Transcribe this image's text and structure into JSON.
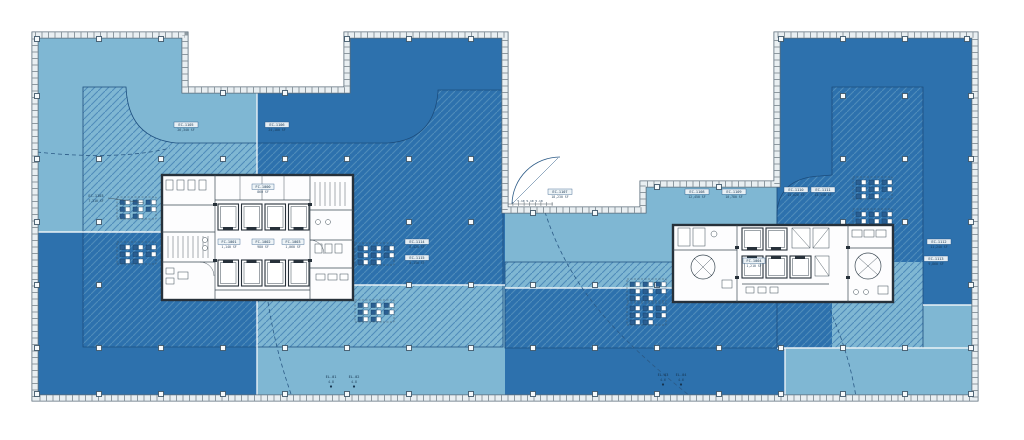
{
  "plan": {
    "colors": {
      "zone_light": "#7fb7d3",
      "zone_dark": "#2d71ad",
      "hatch_line": "#4f8cba",
      "boundary": "#1c4d7d",
      "wall": "#27313a",
      "core_fill": "#fdfdfe",
      "core_line": "#3c4a54",
      "band_fill": "#e9eff2",
      "band_tick": "#44525c",
      "band_edge": "#5a6b78",
      "match_line": "#f0f6f9",
      "column_fill": "#f5f9fb",
      "column_edge": "#41586a",
      "label_box": "#eef4f7",
      "label_ink": "#16344f",
      "annot": "#2b5a86",
      "riser_dark": "#2a5e92",
      "riser_edge": "#123c63"
    },
    "labels": [
      {
        "id": "EC-1105",
        "area": "26,340 SF"
      },
      {
        "id": "EC-1106",
        "area": "24,180 SF"
      },
      {
        "id": "EC-1107",
        "area": "18,230 SF"
      },
      {
        "id": "EC-1108",
        "area": "12,450 SF"
      },
      {
        "id": "EC-1109",
        "area": "10,780 SF"
      },
      {
        "id": "EC-1110",
        "area": "15,620 SF"
      },
      {
        "id": "EC-1111",
        "area": "13,910 SF"
      },
      {
        "id": "EC-1112",
        "area": "11,240 SF"
      },
      {
        "id": "EC-1113",
        "area": "9,860 SF"
      },
      {
        "id": "EC-1114",
        "area": "8,420 SF"
      },
      {
        "id": "EC-1115",
        "area": "8,150 SF"
      },
      {
        "id": "EC-1103",
        "area": "7,310 SF"
      },
      {
        "id": "FC-1001",
        "area": "1,140 SF"
      },
      {
        "id": "FC-1002",
        "area": "980 SF"
      },
      {
        "id": "FC-1003",
        "area": "1,060 SF"
      },
      {
        "id": "FC-1004",
        "area": "1,210 SF"
      },
      {
        "id": "FC-1000",
        "area": "860 SF"
      },
      {
        "id": "EL-01",
        "area": "4.8"
      },
      {
        "id": "EL-02",
        "area": "4.8"
      },
      {
        "id": "EL-03",
        "area": "4.6"
      },
      {
        "id": "EL-04",
        "area": "4.6"
      }
    ],
    "annotations": {
      "dim_text": "5.10 5.10 5.10"
    },
    "structure": {
      "column_markers": [
        [
          37,
          39
        ],
        [
          99,
          39
        ],
        [
          161,
          39
        ],
        [
          223,
          93
        ],
        [
          285,
          93
        ],
        [
          347,
          39
        ],
        [
          409,
          39
        ],
        [
          471,
          39
        ],
        [
          533,
          213
        ],
        [
          595,
          213
        ],
        [
          657,
          187
        ],
        [
          719,
          187
        ],
        [
          781,
          39
        ],
        [
          843,
          39
        ],
        [
          905,
          39
        ],
        [
          967,
          39
        ],
        [
          37,
          96
        ],
        [
          37,
          159
        ],
        [
          37,
          222
        ],
        [
          37,
          285
        ],
        [
          37,
          348
        ],
        [
          37,
          394
        ],
        [
          971,
          96
        ],
        [
          971,
          159
        ],
        [
          971,
          222
        ],
        [
          971,
          285
        ],
        [
          971,
          348
        ],
        [
          971,
          394
        ],
        [
          99,
          394
        ],
        [
          161,
          394
        ],
        [
          223,
          394
        ],
        [
          285,
          394
        ],
        [
          347,
          394
        ],
        [
          409,
          394
        ],
        [
          471,
          394
        ],
        [
          533,
          394
        ],
        [
          595,
          394
        ],
        [
          657,
          394
        ],
        [
          719,
          394
        ],
        [
          781,
          394
        ],
        [
          843,
          394
        ],
        [
          905,
          394
        ],
        [
          99,
          159
        ],
        [
          161,
          159
        ],
        [
          223,
          159
        ],
        [
          285,
          159
        ],
        [
          347,
          159
        ],
        [
          409,
          159
        ],
        [
          471,
          159
        ],
        [
          99,
          222
        ],
        [
          409,
          222
        ],
        [
          471,
          222
        ],
        [
          99,
          285
        ],
        [
          409,
          285
        ],
        [
          471,
          285
        ],
        [
          99,
          348
        ],
        [
          161,
          348
        ],
        [
          223,
          348
        ],
        [
          285,
          348
        ],
        [
          347,
          348
        ],
        [
          409,
          348
        ],
        [
          471,
          348
        ],
        [
          533,
          285
        ],
        [
          595,
          285
        ],
        [
          657,
          285
        ],
        [
          533,
          348
        ],
        [
          595,
          348
        ],
        [
          657,
          348
        ],
        [
          719,
          348
        ],
        [
          781,
          348
        ],
        [
          843,
          348
        ],
        [
          905,
          348
        ],
        [
          843,
          96
        ],
        [
          905,
          96
        ],
        [
          843,
          159
        ],
        [
          905,
          159
        ],
        [
          843,
          222
        ],
        [
          905,
          222
        ]
      ]
    }
  }
}
